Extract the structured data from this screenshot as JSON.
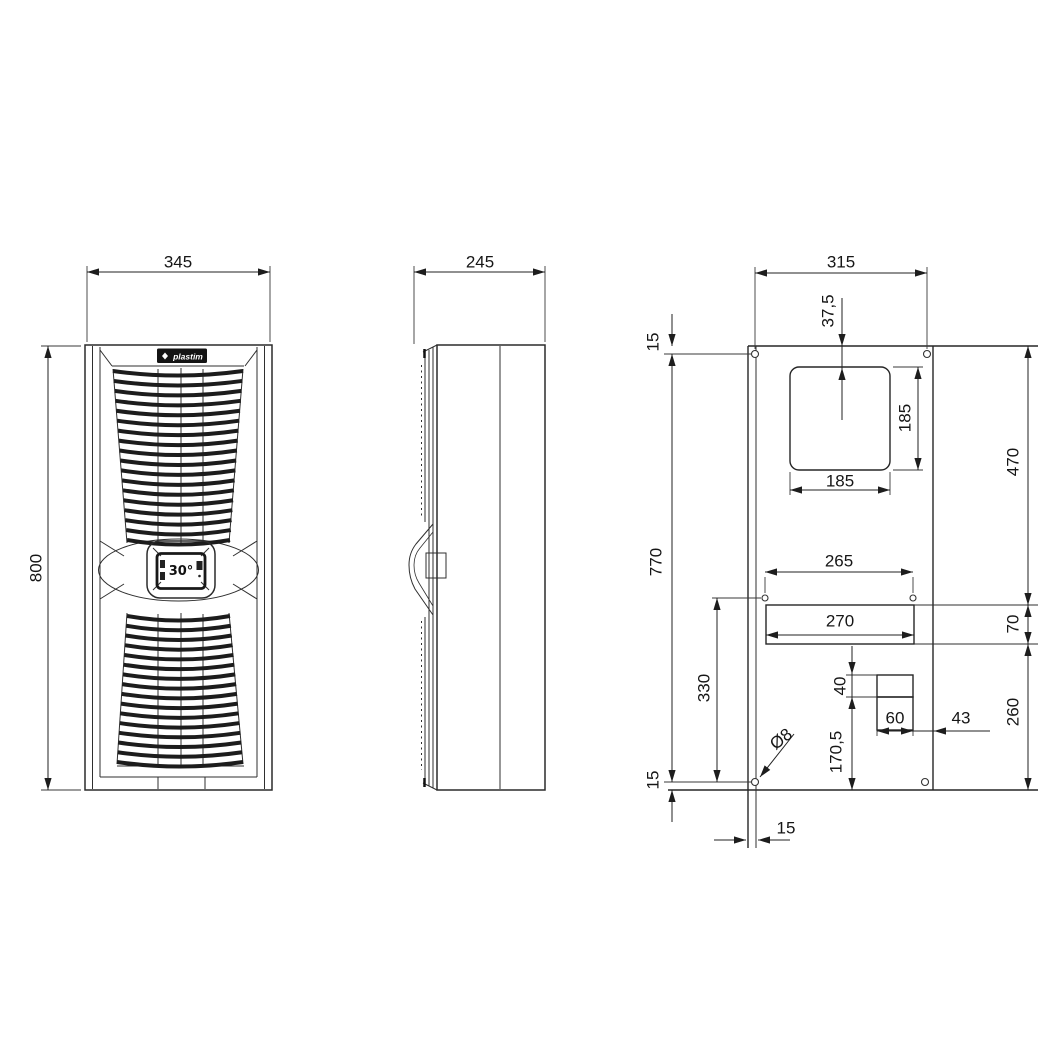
{
  "drawing": {
    "front_view": {
      "logo_text": "plastim",
      "display_temperature": "30°",
      "width_mm": "345",
      "height_mm": "800"
    },
    "side_view": {
      "depth_mm": "245"
    },
    "cutout_view": {
      "hole_span_horizontal": "315",
      "square_cutout_top_offset": "37,5",
      "top_edge_to_hole": "15",
      "square_cutout_width": "185",
      "square_cutout_height": "185",
      "top_to_slot": "470",
      "slot_height": "70",
      "slot_to_bottom": "260",
      "hole_span_vertical": "770",
      "bottom_edge_to_hole": "15",
      "hole_edge_inset": "15",
      "slot_hole_span": "265",
      "slot_width": "270",
      "mid_hole_to_bottom": "330",
      "step_upper_height": "40",
      "step_width": "60",
      "step_to_right_edge": "43",
      "step_to_bottom": "170,5",
      "hole_diameter": "Ø8"
    }
  }
}
